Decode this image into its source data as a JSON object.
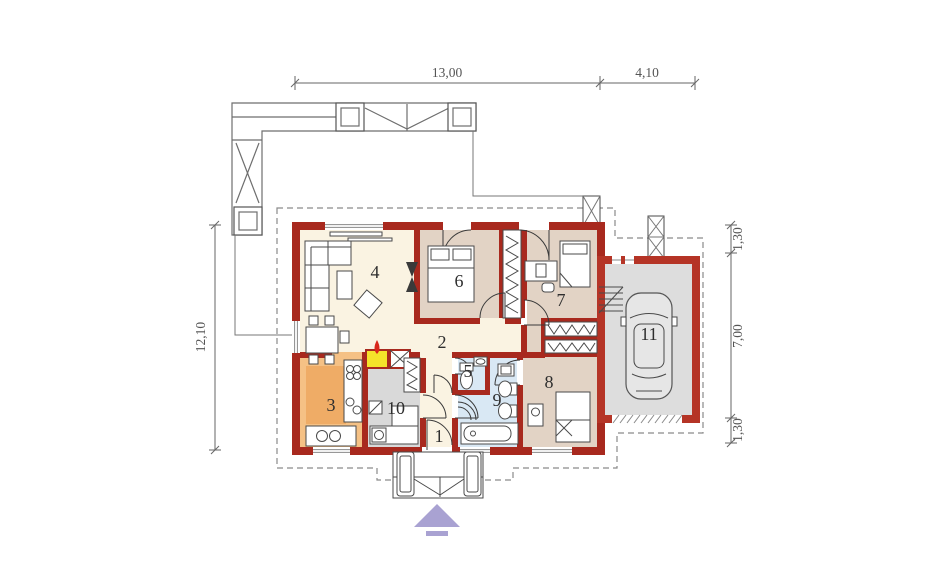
{
  "plan": {
    "dimensions": {
      "top": [
        {
          "label": "13,00"
        },
        {
          "label": "4,10"
        }
      ],
      "left": [
        {
          "label": "12,10"
        }
      ],
      "right": [
        {
          "label": "1,30"
        },
        {
          "label": "7,00"
        },
        {
          "label": "1,30"
        }
      ]
    },
    "rooms": [
      {
        "number": "1"
      },
      {
        "number": "2"
      },
      {
        "number": "3"
      },
      {
        "number": "4"
      },
      {
        "number": "5"
      },
      {
        "number": "6"
      },
      {
        "number": "7"
      },
      {
        "number": "8"
      },
      {
        "number": "9"
      },
      {
        "number": "10"
      },
      {
        "number": "11"
      }
    ],
    "colors": {
      "wall": "#A8291E",
      "garage_wall": "#B53426",
      "floor_cream": "#FAF3E2",
      "floor_tan": "#E2D3C5",
      "floor_blue": "#D9E8F4",
      "floor_orange": "#F5C185",
      "floor_gray": "#D9D9D9",
      "fireplace_yellow": "#F5E32A",
      "entrance_arrow_purple": "#A9A2D2"
    }
  }
}
